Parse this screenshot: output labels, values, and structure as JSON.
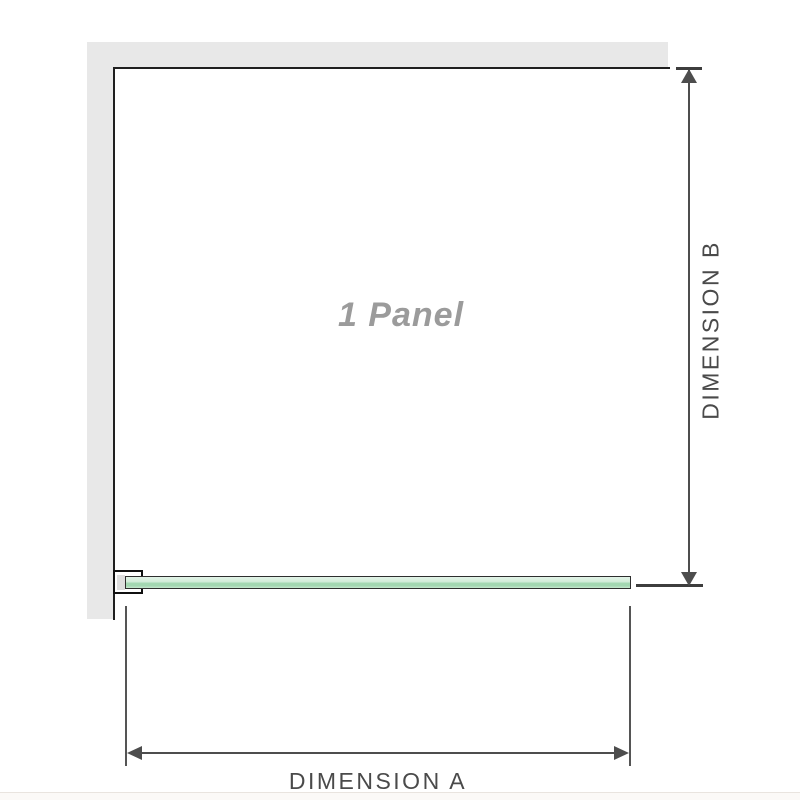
{
  "diagram": {
    "panel_label": "1 Panel",
    "dimensions": {
      "a_label": "DIMENSION A",
      "b_label": "DIMENSION B"
    },
    "icons": [
      "arrow-up-icon",
      "arrow-down-icon",
      "arrow-left-icon",
      "arrow-right-icon"
    ],
    "colors": {
      "wall_fill": "#e8e8e8",
      "panel_outline": "#1f1f1f",
      "dimension_lines": "#4d4d4d",
      "dimension_text": "#4a4a4a",
      "panel_label_text": "#9b9b9b",
      "glass_green_light": "#d3edda",
      "glass_green_dark": "#a2d7b1",
      "clamp_inner_fill": "#dedede"
    }
  }
}
